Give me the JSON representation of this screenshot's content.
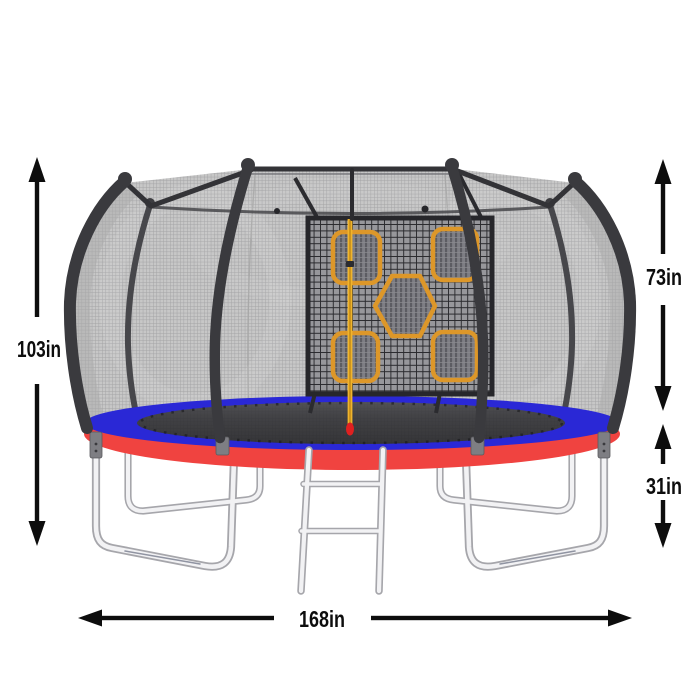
{
  "diagram": {
    "type": "product-dimension-diagram",
    "subject": "trampoline with safety net enclosure, target game panel and ladder",
    "background": "#ffffff",
    "dimensions": {
      "overall_height": {
        "label": "103in",
        "position": "left",
        "orientation": "vertical"
      },
      "enclosure_net_height": {
        "label": "73in",
        "position": "right-top",
        "orientation": "vertical"
      },
      "frame_height": {
        "label": "31in",
        "position": "right-bottom",
        "orientation": "vertical"
      },
      "overall_width": {
        "label": "168in",
        "position": "bottom",
        "orientation": "horizontal"
      }
    },
    "colors": {
      "dimension_arrow": "#0d0d0d",
      "pole_frame": "#3a3a3e",
      "safety_net": "#c5c5c5",
      "target_panel_grid": "#97979b",
      "target_border": "#dd9729",
      "center_pole": "#f0b42c",
      "center_pole_tip": "#e02020",
      "pad_top_blue": "#2a28d6",
      "pad_side_red": "#f04340",
      "jumping_mat": "#2d2d31",
      "legs_chrome": "#f2f2f4"
    },
    "targets_count": 5,
    "parts": [
      "curved-enclosure-poles",
      "safety-net",
      "target-game-panel",
      "square-targets",
      "hexagon-target",
      "center-pole",
      "spring-pad",
      "jumping-mat",
      "u-shaped-legs",
      "ladder"
    ]
  }
}
